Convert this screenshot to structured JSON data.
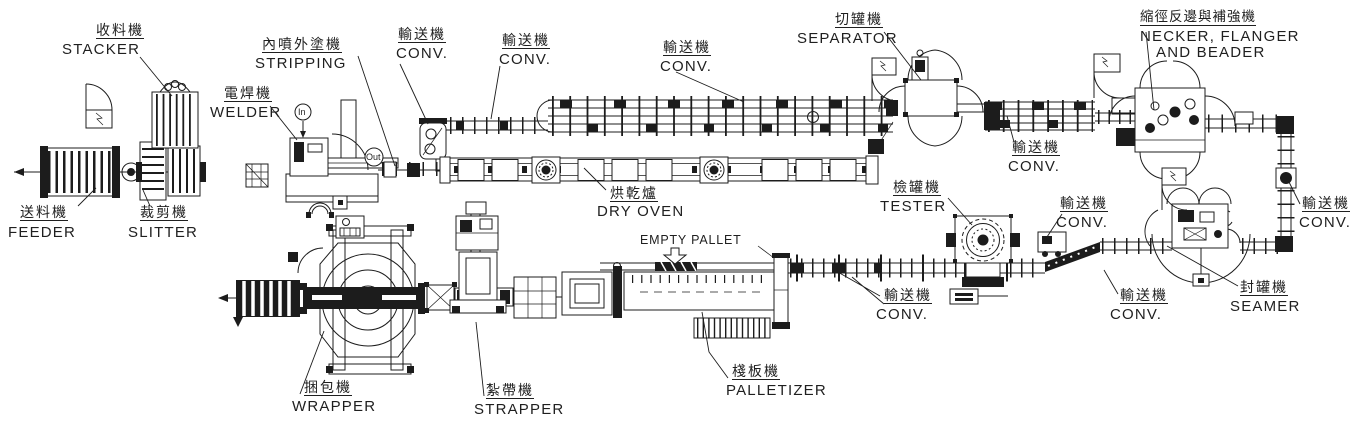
{
  "colors": {
    "ink": "#1c1c1c",
    "paper": "#ffffff"
  },
  "labels": {
    "stacker": {
      "zh": "收料機",
      "en": "STACKER"
    },
    "feeder": {
      "zh": "送料機",
      "en": "FEEDER"
    },
    "slitter": {
      "zh": "裁剪機",
      "en": "SLITTER"
    },
    "stripping": {
      "zh": "內噴外塗機",
      "en": "STRIPPING"
    },
    "welder": {
      "zh": "電焊機",
      "en": "WELDER"
    },
    "conveyor": {
      "zh": "輸送機",
      "en": "CONV."
    },
    "separator": {
      "zh": "切罐機",
      "en": "SEPARATOR"
    },
    "necker": {
      "zh": "縮徑反邊與補強機",
      "en_line1": "NECKER, FLANGER",
      "en_line2": "AND BEADER"
    },
    "dry_oven": {
      "zh": "烘乾爐",
      "en": "DRY OVEN"
    },
    "tester": {
      "zh": "檢罐機",
      "en": "TESTER"
    },
    "seamer": {
      "zh": "封罐機",
      "en": "SEAMER"
    },
    "palletizer": {
      "zh": "棧板機",
      "en": "PALLETIZER"
    },
    "wrapper": {
      "zh": "捆包機",
      "en": "WRAPPER"
    },
    "strapper": {
      "zh": "紮帶機",
      "en": "STRAPPER"
    },
    "empty_pallet": "EMPTY PALLET",
    "flow_in": "In",
    "flow_out": "Out"
  }
}
